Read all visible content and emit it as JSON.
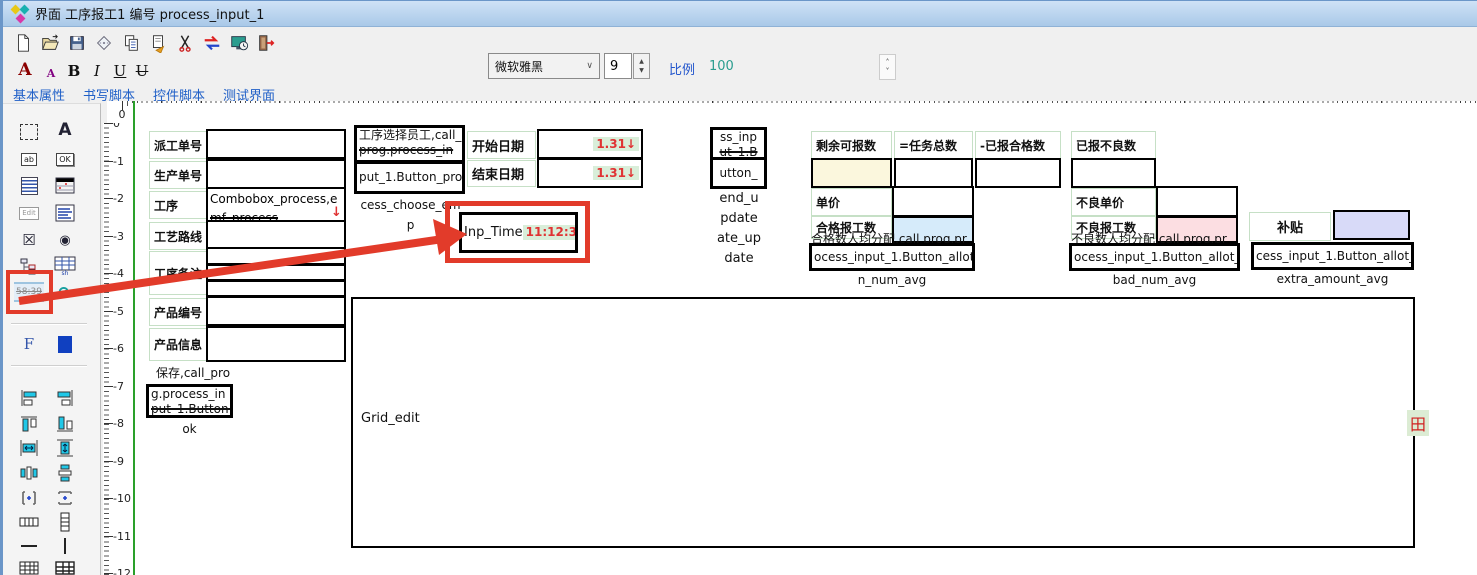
{
  "window": {
    "title": "界面 工序报工1 编号 process_input_1"
  },
  "toolbar": {
    "icons": [
      "new-file",
      "open-folder",
      "save",
      "package",
      "copy",
      "export",
      "cut",
      "swap-arrows",
      "preview-monitor",
      "exit-door"
    ]
  },
  "format_bar": {
    "font_large": "A",
    "font_small": "A",
    "bold": "B",
    "italic": "I",
    "underline": "U",
    "strike": "U",
    "font_name": "微软雅黑",
    "font_size": "9",
    "scale_label": "比例",
    "scale_value": "100"
  },
  "tabs": [
    {
      "label": "基本属性"
    },
    {
      "label": "书写脚本"
    },
    {
      "label": "控件脚本"
    },
    {
      "label": "测试界面"
    }
  ],
  "rulers": {
    "h_start": 0,
    "h_end": 35,
    "v_start": 0,
    "v_end": -12
  },
  "toolbox": {
    "items": [
      "select-marquee",
      "text-label",
      "text-input",
      "ok-button",
      "memo",
      "data-table",
      "edit-box",
      "list-box",
      "checkbox",
      "radio-button",
      "tree-view",
      "grid-sheet",
      "time-display",
      "refresh-globe",
      "function",
      "color-block",
      "align-left",
      "align-right",
      "align-top",
      "align-bottom",
      "fit-width",
      "fit-height",
      "center-horizontal",
      "center-vertical",
      "space-horizontal",
      "space-vertical",
      "table-columns",
      "table-rows",
      "horizontal-line",
      "vertical-line",
      "grid-small",
      "grid-large"
    ],
    "clock_text": "58:39",
    "input_glyph": "ab",
    "ok_glyph": "OK",
    "edit_glyph": "Edit",
    "sheet_glyph": "sh",
    "f_glyph": "F"
  },
  "icons": {
    "dropdown_arrow": "↓",
    "chevron_down": "∨",
    "spin_up": "▲",
    "spin_down": "▼",
    "scale_up": "˄",
    "scale_down": "˅",
    "checkbox": "☒",
    "radio": "◉",
    "refresh": "⟳"
  },
  "form": {
    "fields": [
      {
        "label": "派工单号"
      },
      {
        "label": "生产单号"
      },
      {
        "label": "工序",
        "value_line1": "Combobox_process,e",
        "value_line2": "mf_process"
      },
      {
        "label": "工艺路线"
      },
      {
        "label": "工序备注"
      },
      {
        "label": "产品编号"
      },
      {
        "label": "产品信息"
      }
    ],
    "save_button": {
      "top_text": "保存,call_pro",
      "line1": "g.process_in",
      "line2": "put_1.Button_",
      "caption": "ok"
    },
    "choose_emp_button": {
      "line1": "工序选择员工,call_",
      "line2": "prog.process_in",
      "line3": "put_1.Button_pro",
      "caption1": "cess_choose_em",
      "caption2": "p"
    },
    "date_fields": [
      {
        "label": "开始日期",
        "value": "1.31↓"
      },
      {
        "label": "结束日期",
        "value": "1.31↓"
      }
    ],
    "inp_time": {
      "label": "Inp_Time",
      "value": "11:12:31"
    },
    "end_update_button": {
      "line1": "ss_inp",
      "line2": "ut_1.B",
      "line3": "utton_",
      "cap1": "end_u",
      "cap2": "pdate",
      "cap3": "ate_up",
      "cap4": "date"
    },
    "qty_labels": [
      {
        "label": "剩余可报数"
      },
      {
        "label": "=任务总数"
      },
      {
        "label": "-已报合格数"
      },
      {
        "label": "已报不良数"
      }
    ],
    "good_group": {
      "price_label": "单价",
      "count_label": "合格报工数",
      "overlay_text": "合格数人均分配,call prog.pr",
      "button_text": "ocess_input_1.Button_allot_i",
      "caption": "n_num_avg"
    },
    "bad_group": {
      "price_label": "不良单价",
      "count_label": "不良报工数",
      "overlay_text": "不良数人均分配,call prog.pr",
      "button_text": "ocess_input_1.Button_allot_",
      "caption": "bad_num_avg"
    },
    "extra_group": {
      "label": "补贴",
      "button_text": "cess_input_1.Button_allot_",
      "caption": "extra_amount_avg"
    },
    "grid": {
      "label": "Grid_edit",
      "handle": "田"
    }
  },
  "colors": {
    "accent_red": "#e23b2a",
    "chip_green_bg": "#d9eed9",
    "chip_red_text": "#e03333",
    "cream": "#fbf7dd",
    "light_blue": "#d6ebfa",
    "pink": "#fcdee2",
    "lavender": "#d8daf8",
    "label_border": "#c6e0c6",
    "origin_green": "#2aa02a"
  }
}
